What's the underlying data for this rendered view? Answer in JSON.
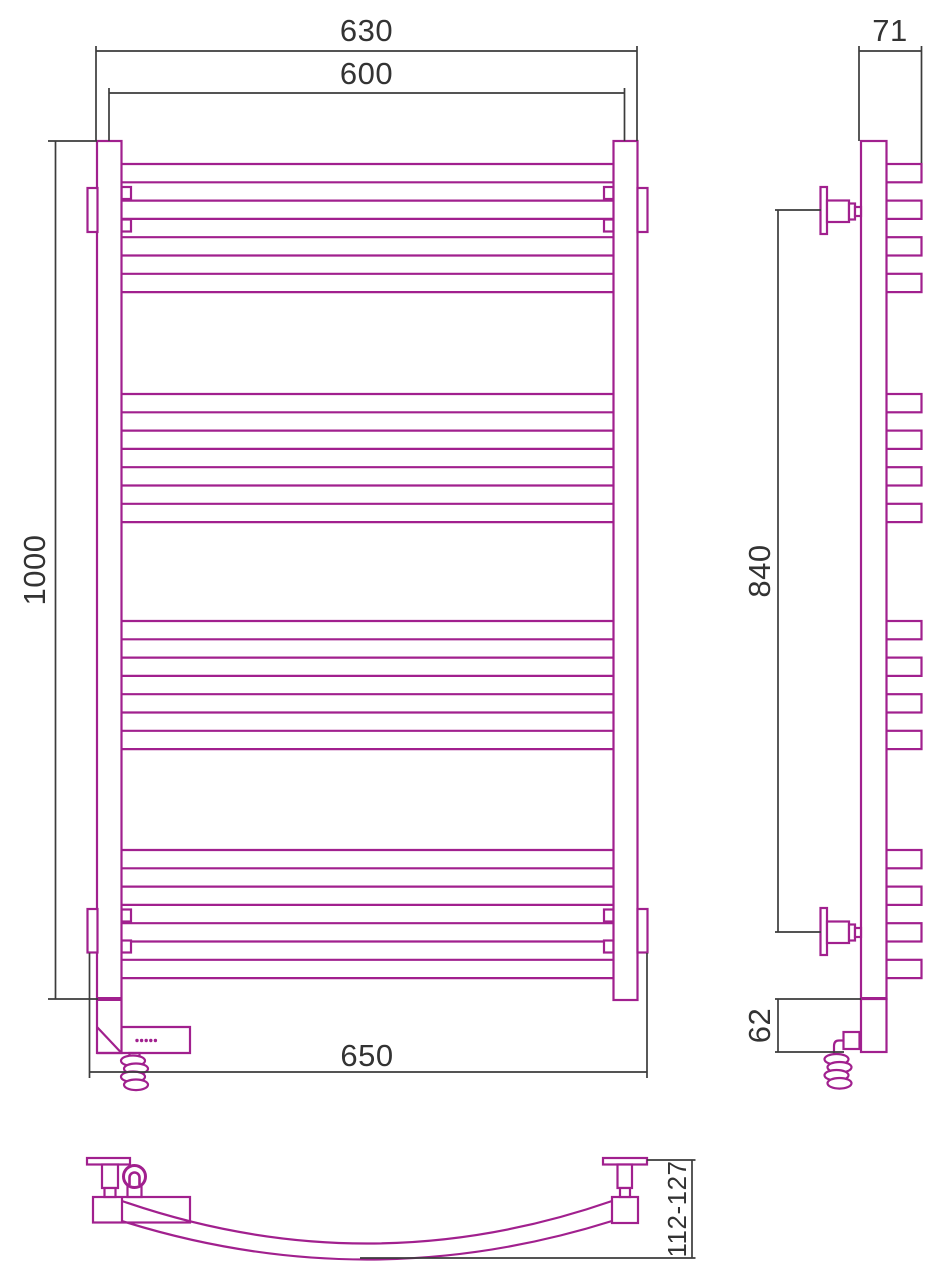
{
  "dimensions": {
    "front_view": {
      "overall_width_mm": "630",
      "mounting_width_mm": "600",
      "overall_height_mm": "1000",
      "bracket_span_mm": "650"
    },
    "side_view": {
      "depth_mm": "71",
      "bracket_spacing_mm": "840",
      "element_offset_mm": "62"
    },
    "bottom_view": {
      "wall_clearance_mm": "112-127"
    }
  },
  "colors": {
    "product_outline": "#a1208e",
    "dimension_line": "#3c3c3c",
    "dimension_text": "#333333",
    "background": "#ffffff"
  }
}
